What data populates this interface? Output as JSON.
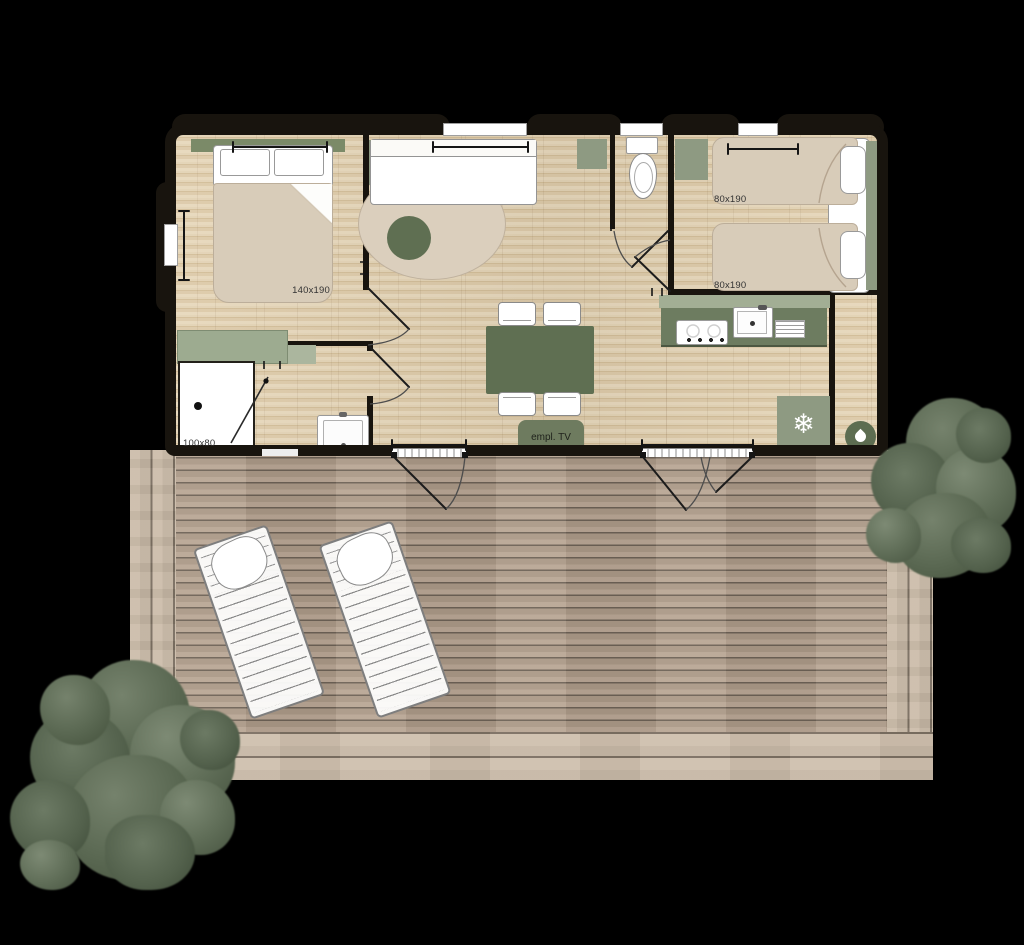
{
  "labels": {
    "master_bed": "140x190",
    "twin_bed_top": "80x190",
    "twin_bed_bottom": "80x190",
    "shower": "100x80",
    "tv": "empl. TV"
  },
  "icons": {
    "fridge_snowflake": "❄",
    "fridge": "snowflake-icon",
    "water_heater": "droplet-icon"
  },
  "colors": {
    "background": "#000000",
    "wall": "#18140e",
    "floor": "#e0d0b2",
    "deck": "#b2a08e",
    "deck_border": "#c8b9a7",
    "sage": "#8e9a82",
    "sage_dark": "#5f6f52",
    "linen": "#d8ccb9",
    "tree": "#5c6a54",
    "furniture_white": "#ffffff"
  }
}
